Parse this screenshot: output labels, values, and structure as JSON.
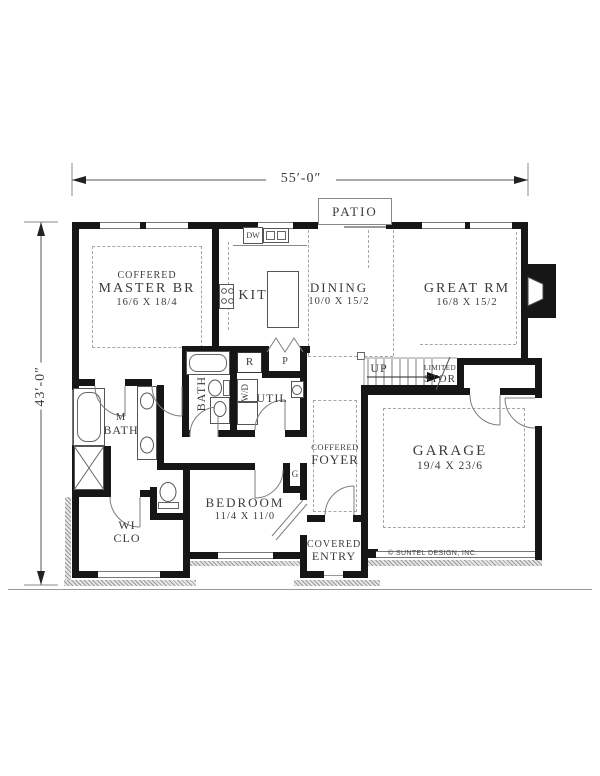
{
  "dims": {
    "width_label": "55′-0″",
    "height_label": "43′-0″"
  },
  "patio_label": "PATIO",
  "copyright": "© SUNTEL DESIGN, INC.",
  "rooms": {
    "master": {
      "ceiling": "COFFERED",
      "name": "MASTER BR",
      "size": "16/6 X 18/4"
    },
    "kitchen": {
      "name": "KIT"
    },
    "dining": {
      "name": "DINING",
      "size": "10/0 X 15/2"
    },
    "great_room": {
      "name": "GREAT RM",
      "size": "16/8 X 15/2"
    },
    "master_bath": {
      "line1": "M",
      "line2": "BATH"
    },
    "bath": {
      "name": "BATH"
    },
    "utility": {
      "name": "UTIL"
    },
    "walk_in_closet": {
      "line1": "WI",
      "line2": "CLO"
    },
    "bedroom": {
      "name": "BEDROOM",
      "size": "11/4 X 11/0"
    },
    "foyer": {
      "ceiling": "COFFERED",
      "name": "FOYER"
    },
    "garage": {
      "name": "GARAGE",
      "size": "19/4 X 23/6"
    },
    "covered_entry": {
      "line1": "COVERED",
      "line2": "ENTRY"
    },
    "stairs": {
      "direction": "UP",
      "storage_line1": "LIMITED",
      "storage_line2": "STOR"
    }
  },
  "fixtures": {
    "dishwasher": "DW",
    "refrigerator": "R",
    "pantry": "P",
    "washer_dryer": "W/D",
    "coat_closet": "G"
  }
}
